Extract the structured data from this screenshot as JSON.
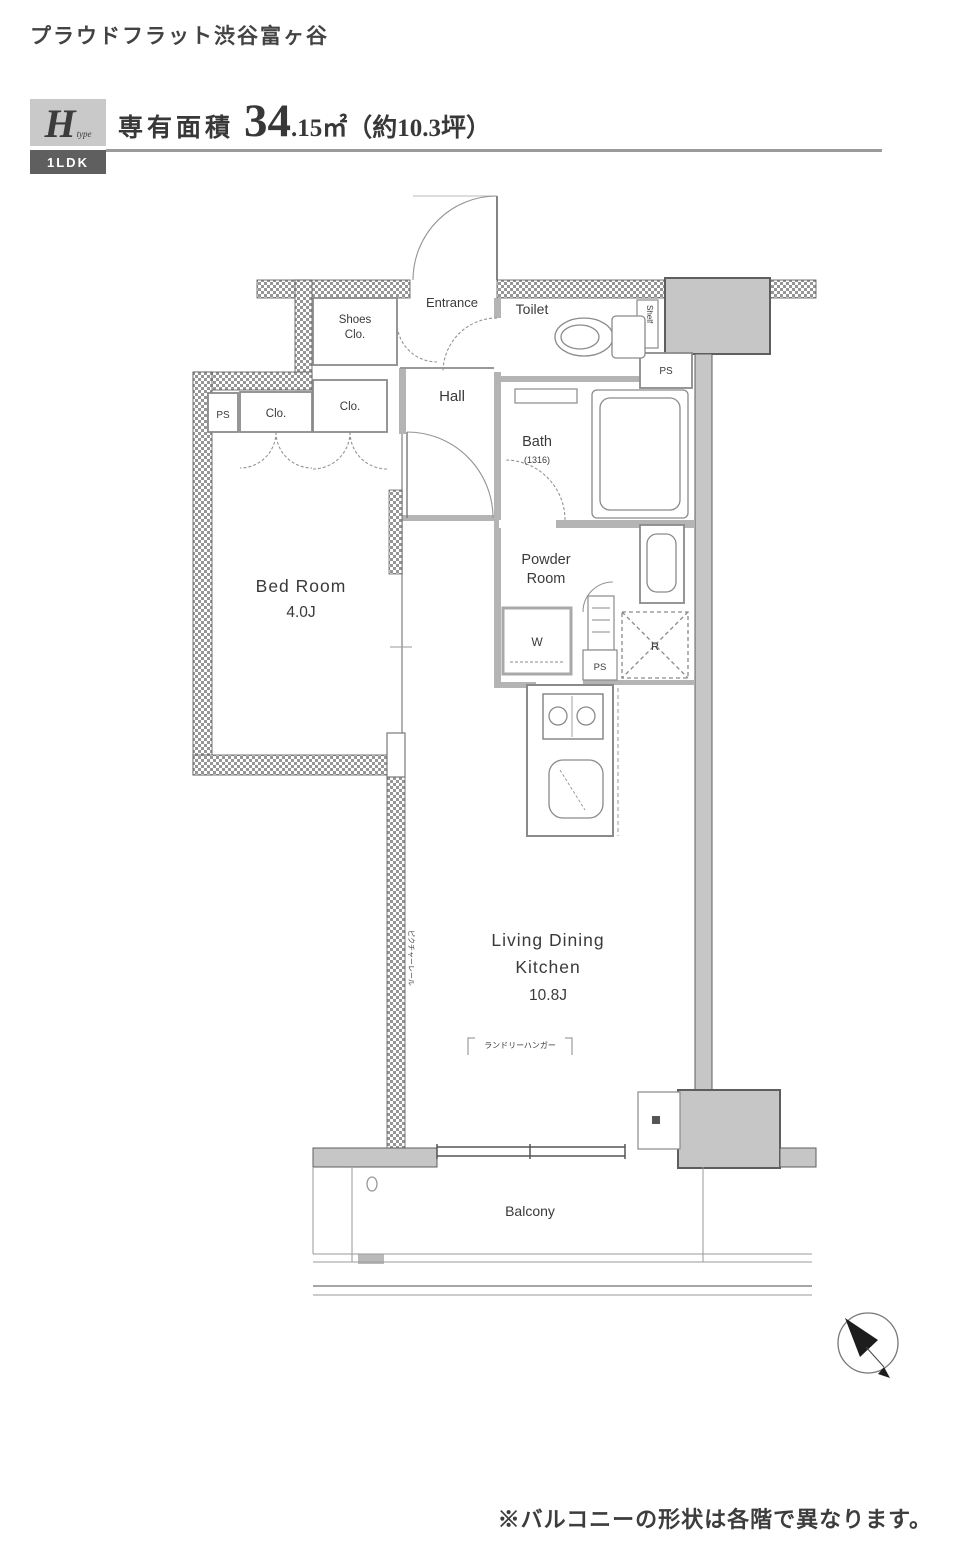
{
  "page": {
    "title": "プラウドフラット渋谷富ヶ谷",
    "footnote": "※バルコニーの形状は各階で異なります。"
  },
  "header": {
    "type_letter": "H",
    "type_word": "type",
    "layout_badge": "1LDK",
    "area_label": "専有面積",
    "area_value_main": "34",
    "area_value_decimal": ".15㎡",
    "area_tsubo": "（約10.3坪）"
  },
  "floorplan": {
    "rooms": {
      "entrance": "Entrance",
      "hall": "Hall",
      "toilet": "Toilet",
      "shoes_closet_line1": "Shoes",
      "shoes_closet_line2": "Clo.",
      "bath": "Bath",
      "bath_size": "(1316)",
      "powder_line1": "Powder",
      "powder_line2": "Room",
      "bedroom_line1": "Bed Room",
      "bedroom_line2": "4.0J",
      "ldk_line1": "Living Dining",
      "ldk_line2": "Kitchen",
      "ldk_line3": "10.8J",
      "balcony": "Balcony"
    },
    "labels": {
      "ps": "PS",
      "closet": "Clo.",
      "washer": "W",
      "refrigerator": "R",
      "shelf": "Shelf",
      "laundry_hanger": "ランドリーハンガー",
      "wall_annotation": "ピクチャーレール"
    },
    "colors": {
      "structural_gray": "#c6c6c6",
      "interior_wall": "#b4b4b4",
      "hatch_dot": "#969696",
      "text": "#3a3a3a"
    }
  }
}
